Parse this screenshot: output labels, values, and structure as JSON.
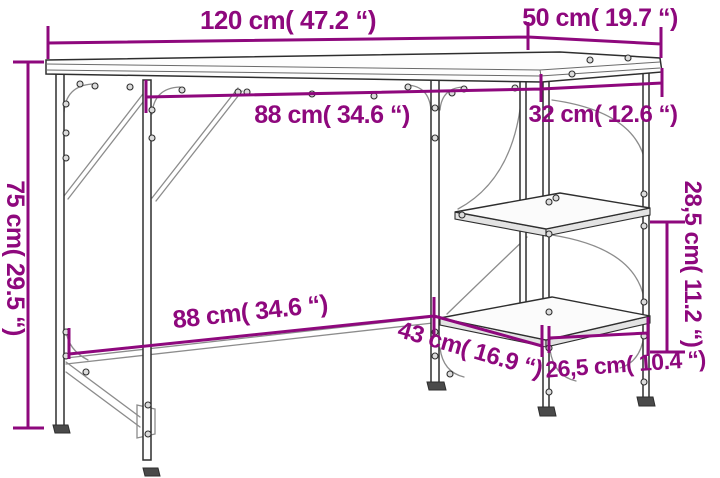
{
  "diagram": {
    "name": "desk-dimension-diagram",
    "background_color": "#ffffff",
    "accent_color": "#8E087D",
    "line_color": "#2e2e2e",
    "dimensions": [
      {
        "id": "overall-width",
        "label": "120 cm( 47.2 “)",
        "cm": "120",
        "inches": "47.2"
      },
      {
        "id": "overall-depth",
        "label": "50 cm( 19.7 “)",
        "cm": "50",
        "inches": "19.7"
      },
      {
        "id": "top-clearance-width",
        "label": "88 cm( 34.6 “)",
        "cm": "88",
        "inches": "34.6"
      },
      {
        "id": "shelf-width",
        "label": "32 cm( 12.6 “)",
        "cm": "32",
        "inches": "12.6"
      },
      {
        "id": "overall-height",
        "label": "75 cm( 29.5 “)",
        "cm": "75",
        "inches": "29.5"
      },
      {
        "id": "shelf-gap-height",
        "label": "28,5 cm( 11.2 “)",
        "cm": "28,5",
        "inches": "11.2"
      },
      {
        "id": "bottom-clearance-width",
        "label": "88 cm( 34.6 “)",
        "cm": "88",
        "inches": "34.6"
      },
      {
        "id": "lower-shelf-diagonal",
        "label": "43 cm( 16.9 “)",
        "cm": "43",
        "inches": "16.9"
      },
      {
        "id": "shelf-depth",
        "label": "26,5 cm( 10.4 “)",
        "cm": "26,5",
        "inches": "10.4"
      }
    ]
  }
}
